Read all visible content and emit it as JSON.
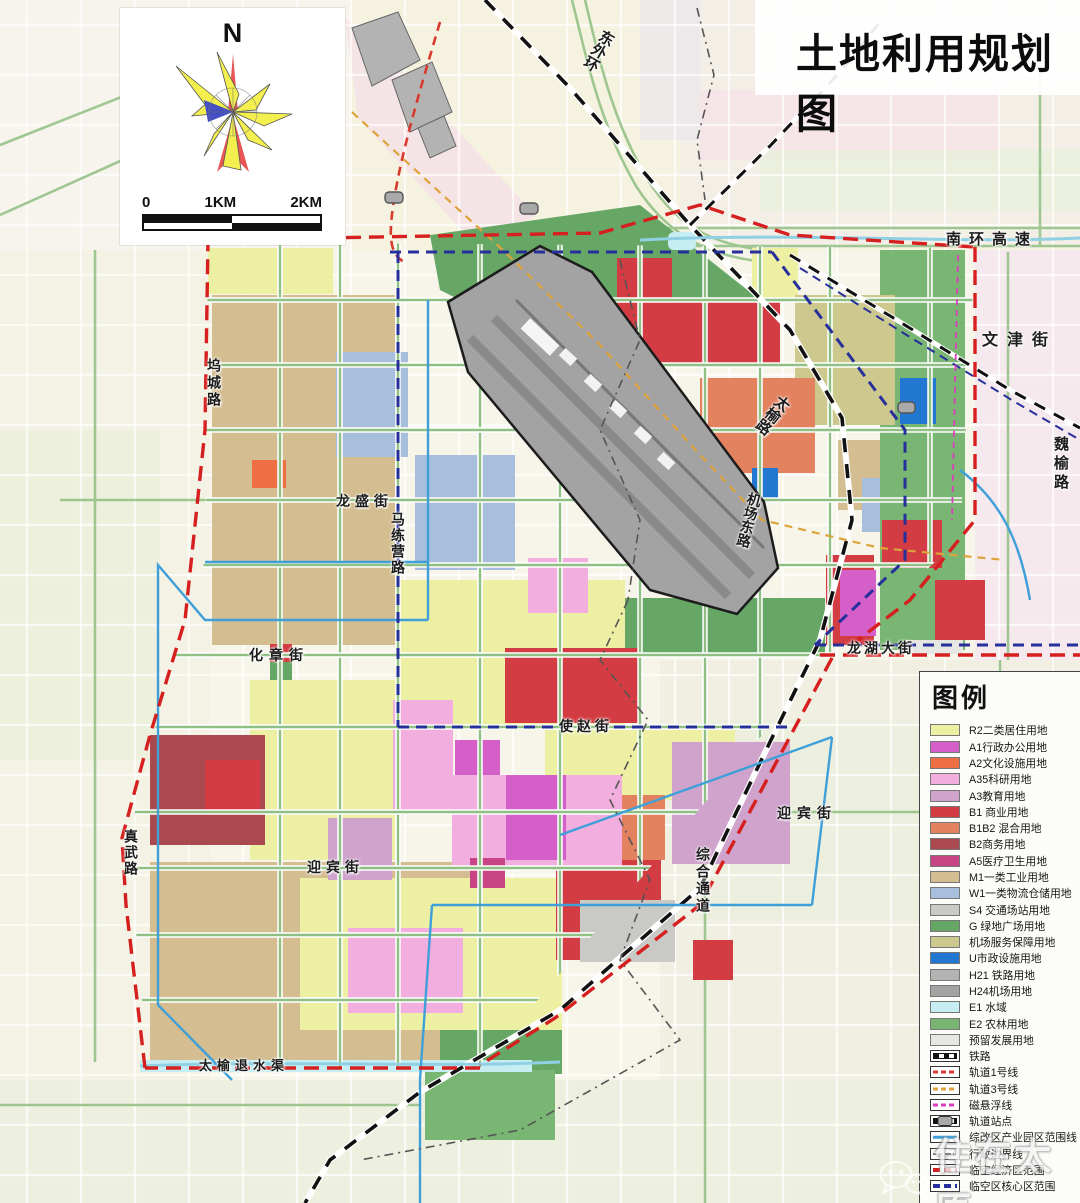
{
  "title": "土地利用规划图",
  "compass": {
    "north_label": "N"
  },
  "scale_bar": {
    "labels": [
      "0",
      "1KM",
      "2KM"
    ]
  },
  "legend": {
    "title": "图例",
    "items": [
      {
        "label": "R2二类居住用地",
        "swatch": "fill",
        "color": "#edf0a3"
      },
      {
        "label": "A1行政办公用地",
        "swatch": "fill",
        "color": "#d45fc8"
      },
      {
        "label": "A2文化设施用地",
        "swatch": "fill",
        "color": "#ef6f45"
      },
      {
        "label": "A35科研用地",
        "swatch": "fill",
        "color": "#f2aede"
      },
      {
        "label": "A3教育用地",
        "swatch": "fill",
        "color": "#cfa3cc"
      },
      {
        "label": "B1 商业用地",
        "swatch": "fill",
        "color": "#d23c42"
      },
      {
        "label": "B1B2 混合用地",
        "swatch": "fill",
        "color": "#e2825f"
      },
      {
        "label": "B2商务用地",
        "swatch": "fill",
        "color": "#aa4a50"
      },
      {
        "label": "A5医疗卫生用地",
        "swatch": "fill",
        "color": "#c84585"
      },
      {
        "label": "M1一类工业用地",
        "swatch": "fill",
        "color": "#d4bd90"
      },
      {
        "label": "W1一类物流仓储用地",
        "swatch": "fill",
        "color": "#a8bedd"
      },
      {
        "label": "S4 交通场站用地",
        "swatch": "fill",
        "color": "#c9c9c6"
      },
      {
        "label": "G 绿地广场用地",
        "swatch": "fill",
        "color": "#67a765"
      },
      {
        "label": "机场服务保障用地",
        "swatch": "fill",
        "color": "#cdc88e"
      },
      {
        "label": "U市政设施用地",
        "swatch": "fill",
        "color": "#2277d0"
      },
      {
        "label": "H21 铁路用地",
        "swatch": "fill",
        "color": "#b3b3b3"
      },
      {
        "label": "H24机场用地",
        "swatch": "fill",
        "color": "#a3a3a3"
      },
      {
        "label": "E1 水域",
        "swatch": "fill",
        "color": "#c6eef2"
      },
      {
        "label": "E2 农林用地",
        "swatch": "fill",
        "color": "#79b573"
      },
      {
        "label": "预留发展用地",
        "swatch": "fill",
        "color": "#e6e6e2"
      },
      {
        "label": "铁路",
        "swatch": "railway",
        "color": "#111111"
      },
      {
        "label": "轨道1号线",
        "swatch": "dash",
        "color": "#d93a2e"
      },
      {
        "label": "轨道3号线",
        "swatch": "dash",
        "color": "#dea33a"
      },
      {
        "label": "磁悬浮线",
        "swatch": "dash",
        "color": "#db3fbe"
      },
      {
        "label": "轨道站点",
        "swatch": "station",
        "color": "#a9a9a9"
      },
      {
        "label": "综改区产业园区范围线",
        "swatch": "solid",
        "color": "#3f9fd8"
      },
      {
        "label": "行政边界线",
        "swatch": "dashdot",
        "color": "#7a7a7a"
      },
      {
        "label": "临空经济区范围",
        "swatch": "dash-thick",
        "color": "#d61f1f"
      },
      {
        "label": "临空区核心区范围",
        "swatch": "dash-thick",
        "color": "#27309a"
      }
    ]
  },
  "map": {
    "street_labels": [
      {
        "text": "东外环",
        "x": 588,
        "y": 28,
        "mode": "v",
        "rotate": 30,
        "size": 15
      },
      {
        "text": "南环高速",
        "x": 946,
        "y": 228,
        "mode": "h",
        "spacing": 8,
        "size": 15
      },
      {
        "text": "文津街",
        "x": 982,
        "y": 326,
        "mode": "h",
        "spacing": 9,
        "size": 16
      },
      {
        "text": "魏榆路",
        "x": 1050,
        "y": 436,
        "mode": "v",
        "spacing": 4,
        "size": 15
      },
      {
        "text": "坞城路",
        "x": 204,
        "y": 358,
        "mode": "v",
        "spacing": 3,
        "size": 14
      },
      {
        "text": "龙盛街",
        "x": 336,
        "y": 491,
        "mode": "h",
        "spacing": 5,
        "size": 14
      },
      {
        "text": "马练营路",
        "x": 388,
        "y": 512,
        "mode": "v",
        "spacing": 2,
        "size": 14
      },
      {
        "text": "太榆路",
        "x": 762,
        "y": 392,
        "mode": "v",
        "rotate": 38,
        "size": 15
      },
      {
        "text": "机场东路",
        "x": 739,
        "y": 492,
        "mode": "v",
        "rotate": 14,
        "size": 14
      },
      {
        "text": "化章街",
        "x": 249,
        "y": 645,
        "mode": "h",
        "spacing": 6,
        "size": 14
      },
      {
        "text": "使赵街",
        "x": 559,
        "y": 716,
        "mode": "h",
        "spacing": 4,
        "size": 14
      },
      {
        "text": "龙湖大街",
        "x": 847,
        "y": 638,
        "mode": "h",
        "spacing": 3,
        "size": 14
      },
      {
        "text": "迎宾街",
        "x": 777,
        "y": 803,
        "mode": "h",
        "spacing": 6,
        "size": 14
      },
      {
        "text": "综合通道",
        "x": 693,
        "y": 847,
        "mode": "v",
        "spacing": 3,
        "size": 14
      },
      {
        "text": "真武路",
        "x": 121,
        "y": 829,
        "mode": "v",
        "spacing": 2,
        "size": 14
      },
      {
        "text": "迎宾街",
        "x": 307,
        "y": 857,
        "mode": "h",
        "spacing": 5,
        "size": 14
      },
      {
        "text": "太榆退水渠",
        "x": 199,
        "y": 1055,
        "mode": "h",
        "spacing": 5,
        "size": 13
      }
    ]
  },
  "watermark": {
    "text": "住在太原",
    "icon": "wechat-icon"
  },
  "colors": {
    "bg": "#f7f5ea",
    "outside_pink": "#f5e2e6",
    "outside_green": "#e9efdb",
    "outside_cream": "#f6f2e0",
    "outside_lav": "#e9e4ef",
    "road_green": "#8fbf82",
    "road_white": "#ffffff",
    "r2": "#edf0a3",
    "a1": "#d45fc8",
    "a2": "#ef6f45",
    "a35": "#f2aede",
    "a3": "#cfa3cc",
    "b1": "#d23c42",
    "b1b2": "#e2825f",
    "b2": "#aa4a50",
    "a5": "#c84585",
    "m1": "#d4bd90",
    "w1": "#a8bedd",
    "s4": "#c9c9c6",
    "g": "#67a765",
    "airport_service": "#cdc88e",
    "u": "#2277d0",
    "h21": "#b3b3b3",
    "h24": "#a3a3a3",
    "e1": "#c6eef2",
    "e2": "#79b573",
    "reserved": "#e6e6e2",
    "rail_black": "#111111",
    "rail1": "#d93a2e",
    "rail3": "#dea33a",
    "maglev": "#db3fbe",
    "station": "#a9a9a9",
    "reform_blue": "#3f9fd8",
    "admin_gray": "#555555",
    "zone_red": "#d61f1f",
    "core_blue": "#27309a",
    "canal_cyan": "#8fd0e4"
  }
}
